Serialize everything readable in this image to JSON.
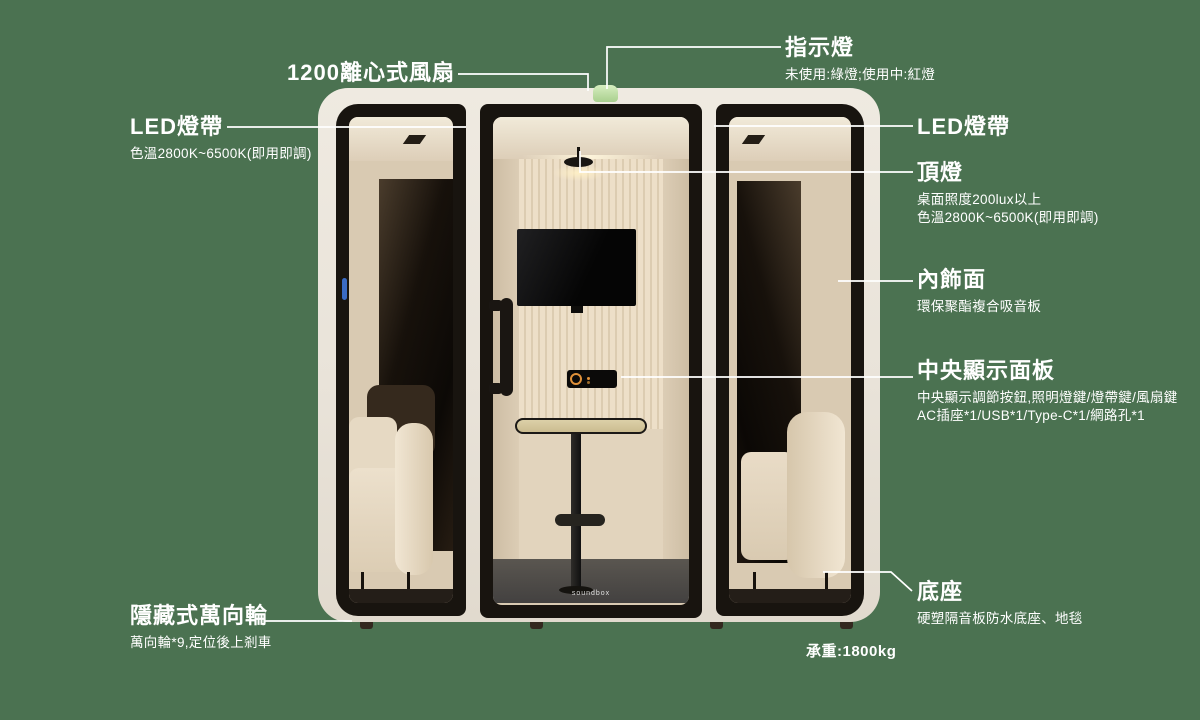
{
  "colors": {
    "background": "#4b7251",
    "booth_shell": "#e9e3d9",
    "frame_black": "#18140f",
    "indicator_green": "#bcdfa2",
    "dial_orange": "#e0913a",
    "annotation_text": "#ffffff"
  },
  "booth": {
    "logo": "soundbox",
    "load_label": "承重:1800kg"
  },
  "annotations": {
    "fan": {
      "title": "1200離心式風扇"
    },
    "indicator": {
      "title": "指示燈",
      "sub": "未使用:綠燈;使用中:紅燈"
    },
    "led_left": {
      "title": "LED燈帶",
      "sub": "色溫2800K~6500K(即用即調)"
    },
    "led_right": {
      "title": "LED燈帶"
    },
    "top_light": {
      "title": "頂燈",
      "sub1": "桌面照度200lux以上",
      "sub2": "色溫2800K~6500K(即用即調)"
    },
    "interior": {
      "title": "內飾面",
      "sub": "環保聚酯複合吸音板"
    },
    "panel": {
      "title": "中央顯示面板",
      "sub1": "中央顯示調節按鈕,照明燈鍵/燈帶鍵/風扇鍵",
      "sub2": "AC插座*1/USB*1/Type-C*1/網路孔*1"
    },
    "base": {
      "title": "底座",
      "sub": "硬塑隔音板防水底座、地毯"
    },
    "wheels": {
      "title": "隱藏式萬向輪",
      "sub": "萬向輪*9,定位後上剎車"
    }
  }
}
